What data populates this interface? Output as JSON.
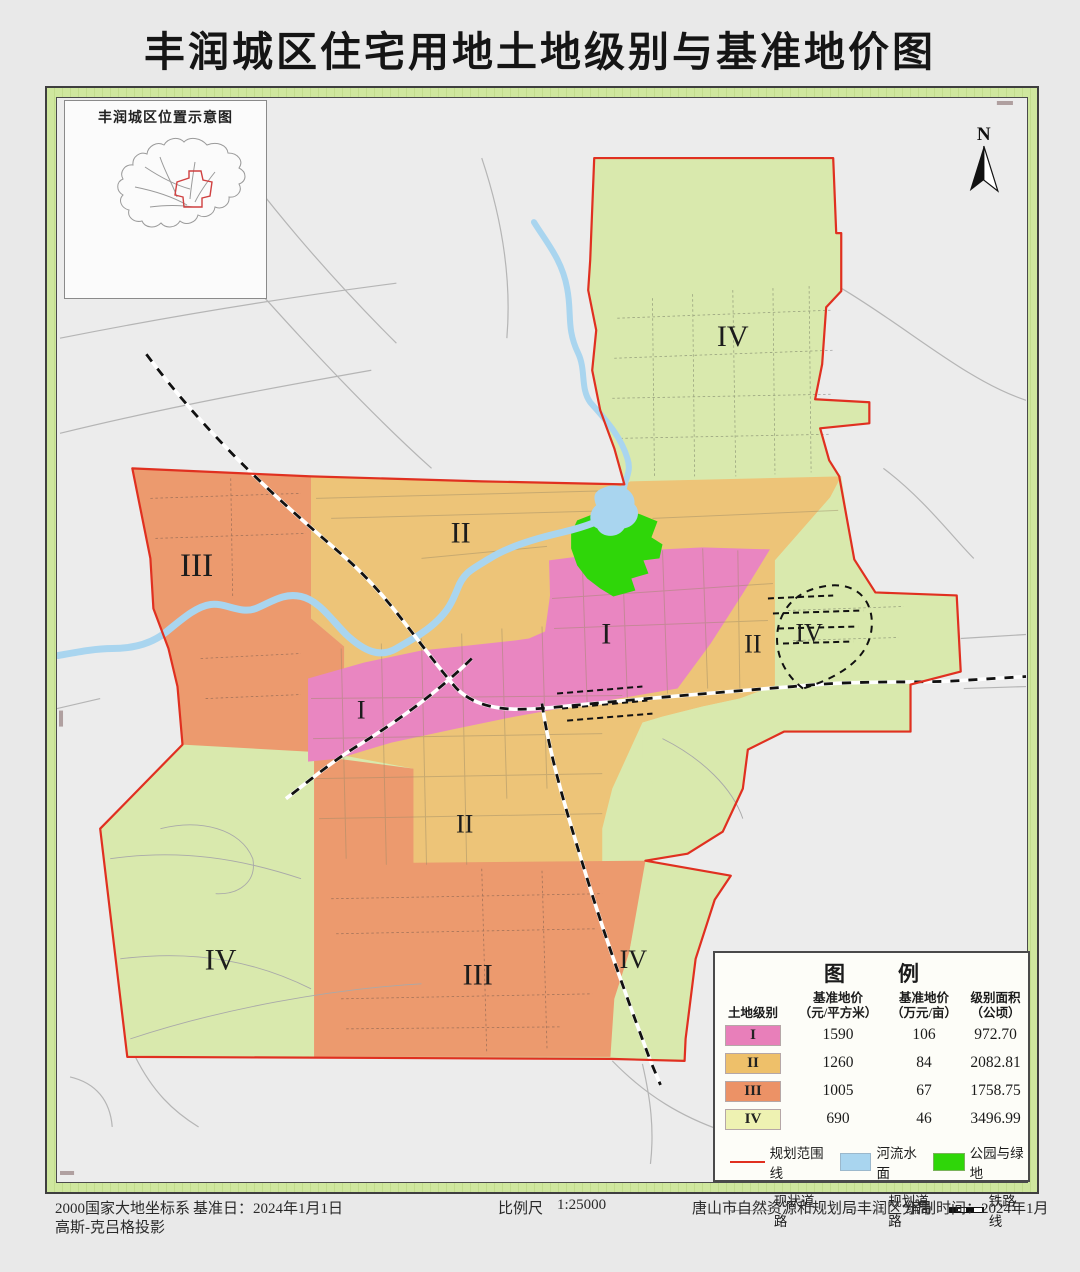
{
  "page_title": "丰润城区住宅用地土地级别与基准地价图",
  "inset": {
    "title": "丰润城区位置示意图"
  },
  "north": {
    "label": "N"
  },
  "map_labels": [
    {
      "text": "IV",
      "x": 730,
      "y": 341,
      "size": 30
    },
    {
      "text": "II",
      "x": 459,
      "y": 537,
      "size": 30
    },
    {
      "text": "III",
      "x": 196,
      "y": 570,
      "size": 33
    },
    {
      "text": "I",
      "x": 604,
      "y": 638,
      "size": 30
    },
    {
      "text": "II",
      "x": 750,
      "y": 648,
      "size": 26
    },
    {
      "text": "IV",
      "x": 806,
      "y": 637,
      "size": 26
    },
    {
      "text": "I",
      "x": 360,
      "y": 714,
      "size": 26
    },
    {
      "text": "II",
      "x": 463,
      "y": 828,
      "size": 26
    },
    {
      "text": "III",
      "x": 476,
      "y": 979,
      "size": 30
    },
    {
      "text": "IV",
      "x": 220,
      "y": 964,
      "size": 30
    },
    {
      "text": "IV",
      "x": 631,
      "y": 963,
      "size": 26
    }
  ],
  "legend": {
    "title": "图　例",
    "headers": {
      "grade": "土地级别",
      "price_sqm_1": "基准地价",
      "price_sqm_2": "（元/平方米）",
      "price_mu_1": "基准地价",
      "price_mu_2": "（万元/亩）",
      "area_1": "级别面积",
      "area_2": "（公顷）"
    },
    "rows": [
      {
        "grade": "I",
        "price_sqm": "1590",
        "price_mu": "106",
        "area": "972.70"
      },
      {
        "grade": "II",
        "price_sqm": "1260",
        "price_mu": "84",
        "area": "2082.81"
      },
      {
        "grade": "III",
        "price_sqm": "1005",
        "price_mu": "67",
        "area": "1758.75"
      },
      {
        "grade": "IV",
        "price_sqm": "690",
        "price_mu": "46",
        "area": "3496.99"
      }
    ],
    "symbols": {
      "boundary": "规划范围线",
      "water": "河流水面",
      "park": "公园与绿地",
      "existing_road": "现状道路",
      "planned_road": "规划道路",
      "railway": "铁路线"
    }
  },
  "footer": {
    "coord_system": "2000国家大地坐标系",
    "projection": "高斯-克吕格投影",
    "base_date": "基准日：2024年1月1日",
    "scale_label": "比例尺",
    "scale_value": "1:25000",
    "agency": "唐山市自然资源和规划局丰润区分局",
    "compile_time": "编制时间：2024年1月"
  },
  "colors": {
    "grade1": "#e986c1",
    "grade2": "#edc478",
    "grade3": "#ec9a6e",
    "grade4": "#d9e9ad",
    "legend_grade1": "#e87fba",
    "legend_grade2": "#eec06a",
    "legend_grade3": "#ec9266",
    "legend_grade4": "#eef2b2",
    "park": "#2fd609",
    "water": "#a9d5ef",
    "boundary": "#e03020",
    "railway": "#111111"
  }
}
